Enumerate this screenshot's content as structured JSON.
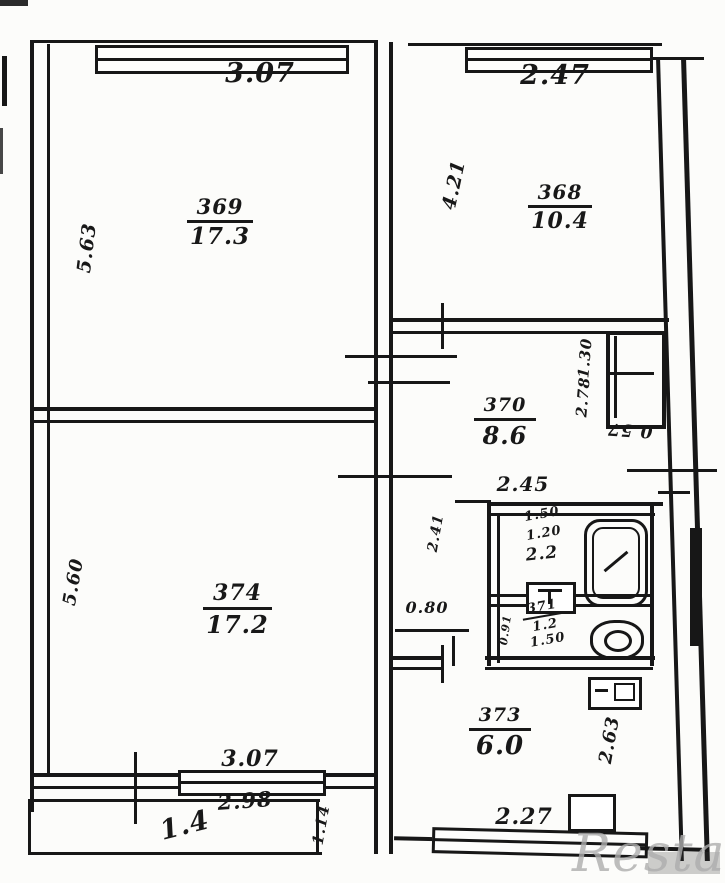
{
  "watermark": "Restate",
  "rooms": {
    "r369": {
      "number": "369",
      "area": "17.3"
    },
    "r368": {
      "number": "368",
      "area": "10.4"
    },
    "r370": {
      "number": "370",
      "area": "8.6"
    },
    "r371": {
      "number": "371",
      "area": "1.2",
      "width": "1.50"
    },
    "bath": {
      "dim1": "1.50",
      "dim2": "1.20",
      "area": "2.2"
    },
    "r373": {
      "number": "373",
      "area": "6.0"
    },
    "r374": {
      "number": "374",
      "area": "17.2"
    },
    "balcony": {
      "area": "1.4"
    }
  },
  "dims": {
    "top_left": "3.07",
    "top_right": "2.47",
    "left_upper": "5.63",
    "room368_side": "4.21",
    "closet_upper": "1.30",
    "closet_side": "2.78",
    "closet_front": "0.57",
    "hall_width": "2.45",
    "bath_side": "2.41",
    "wc_passage": "0.80",
    "wc_side": "0.91",
    "left_lower": "5.60",
    "room374_bottom": "3.07",
    "balcony_top": "2.98",
    "balcony_side": "1.14",
    "kitchen_side": "2.63",
    "kitchen_window": "2.27"
  }
}
